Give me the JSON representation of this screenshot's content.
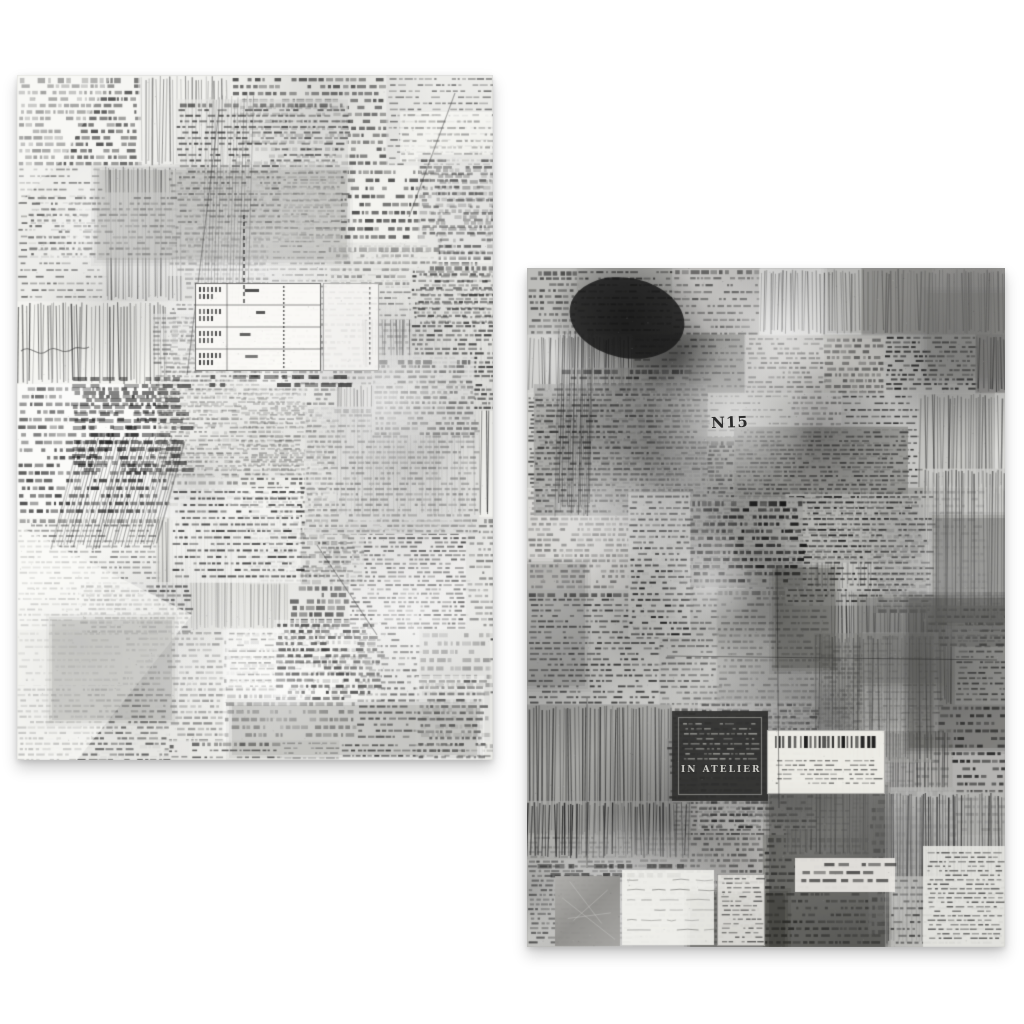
{
  "scene": {
    "background_color": "#ffffff",
    "panels": [
      {
        "name": "left-collage-sheet",
        "tone": "light",
        "x": 17,
        "y": 75,
        "width": 476,
        "height": 685,
        "seed": 20231,
        "base_color": "#f1f0ed",
        "ink_color": "#141414"
      },
      {
        "name": "right-collage-sheet",
        "tone": "dark",
        "x": 527,
        "y": 268,
        "width": 478,
        "height": 679,
        "seed": 98417,
        "base_color": "#b7b6b3",
        "ink_color": "#0f0f0f"
      }
    ],
    "text_fragments": [
      {
        "panel": 1,
        "text": "N15",
        "x": 184,
        "y": 148,
        "size": 15,
        "weight": "bold",
        "color": "#2b2b2b",
        "rotate": -2,
        "letter_spacing": 1
      },
      {
        "panel": 1,
        "text": "IN ATELIER",
        "x": 154,
        "y": 498,
        "size": 9,
        "weight": "bold",
        "color": "#c8c7c2",
        "rotate": 0,
        "letter_spacing": 2
      }
    ]
  }
}
